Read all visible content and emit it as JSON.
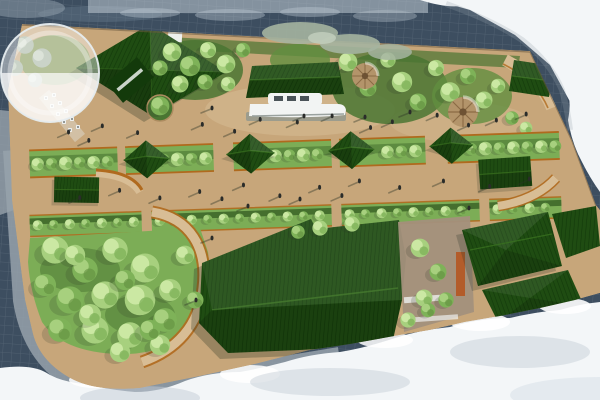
{
  "scene": {
    "type": "aerial-site-plan-rendering",
    "description": "Bird's-eye photomontage rendering of a linear waterfront park masterplan: tan promenades with pedestrians, rows of trees in corten-edged planters, dark green-roofed pavilions and halls, a moored white boat exhibit, a glass dome canopy, dense tree groves, surrounded by slate water, grey roads and white clouds."
  },
  "colors": {
    "cloud_base": "#f3f6f8",
    "cloud_mid": "#dde5eb",
    "cloud_shadow": "#c3ccd5",
    "haze": "#bfcad4",
    "water": "#3d4e60",
    "water_light": "#64778a",
    "road": "#97a2ab",
    "tan": "#c7a67a",
    "tan_light": "#d8bd95",
    "tan_dark": "#ad8c60",
    "lawn": "#7cad56",
    "lawn_dark": "#628f40",
    "planting": "#4a7532",
    "hedge": "#456f2e",
    "tree_light": "#a7d07e",
    "tree_hi": "#cbe8a3",
    "tree_mid": "#7eb258",
    "tree_sage": "#a4b4a0",
    "roof": "#1f4c12",
    "roof_dark": "#133a0b",
    "roof_hi": "#38701f",
    "corten": "#b06a1e",
    "terracotta": "#b35c2a",
    "white_struct": "#eef0ee",
    "boat": "#f2f4f3",
    "gray_plat": "#8e968e",
    "person": "#2a2c2a",
    "shadow": "#2c3526"
  }
}
